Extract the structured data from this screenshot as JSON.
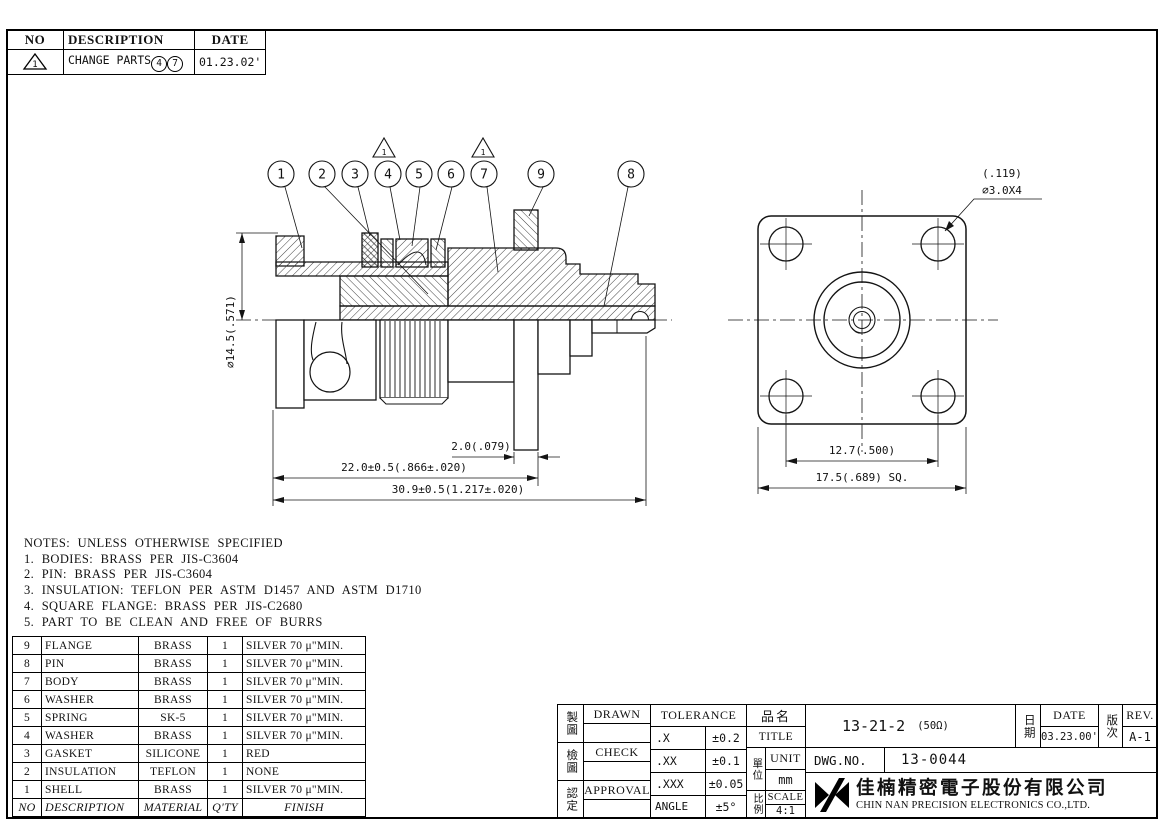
{
  "revision_table": {
    "headers": [
      "NO",
      "DESCRIPTION",
      "DATE"
    ],
    "row": {
      "mark": "1",
      "description": "CHANGE PARTS",
      "parts": [
        "4",
        "7"
      ],
      "date": "01.23.02'"
    }
  },
  "drawing": {
    "balloons": [
      "1",
      "2",
      "3",
      "4",
      "5",
      "6",
      "7",
      "9",
      "8"
    ],
    "rev_mark": "1",
    "side_view": {
      "diameter": "∅14.5(.571)",
      "flange_thickness": "2.0(.079)",
      "body_length": "22.0±0.5(.866±.020)",
      "overall_length": "30.9±0.5(1.217±.020)"
    },
    "front_view": {
      "hole_note_line1": "(.119)",
      "hole_note_line2": "∅3.0X4",
      "hole_spacing": "12.7(.500)",
      "square_size": "17.5(.689) SQ."
    }
  },
  "notes": {
    "title": "NOTES: UNLESS OTHERWISE SPECIFIED",
    "items": [
      "1. BODIES: BRASS PER JIS-C3604",
      "2. PIN: BRASS PER JIS-C3604",
      "3. INSULATION: TEFLON PER ASTM D1457 AND ASTM D1710",
      "4. SQUARE FLANGE: BRASS PER JIS-C2680",
      "5. PART TO BE CLEAN AND FREE OF BURRS"
    ]
  },
  "bom": {
    "headers": {
      "no": "NO",
      "description": "DESCRIPTION",
      "material": "MATERIAL",
      "qty": "Q'TY",
      "finish": "FINISH"
    },
    "rows": [
      {
        "no": "9",
        "description": "FLANGE",
        "material": "BRASS",
        "qty": "1",
        "finish": "SILVER 70 μ\"MIN."
      },
      {
        "no": "8",
        "description": "PIN",
        "material": "BRASS",
        "qty": "1",
        "finish": "SILVER 70 μ\"MIN."
      },
      {
        "no": "7",
        "description": "BODY",
        "material": "BRASS",
        "qty": "1",
        "finish": "SILVER 70 μ\"MIN."
      },
      {
        "no": "6",
        "description": "WASHER",
        "material": "BRASS",
        "qty": "1",
        "finish": "SILVER 70 μ\"MIN."
      },
      {
        "no": "5",
        "description": "SPRING",
        "material": "SK-5",
        "qty": "1",
        "finish": "SILVER 70 μ\"MIN."
      },
      {
        "no": "4",
        "description": "WASHER",
        "material": "BRASS",
        "qty": "1",
        "finish": "SILVER 70 μ\"MIN."
      },
      {
        "no": "3",
        "description": "GASKET",
        "material": "SILICONE",
        "qty": "1",
        "finish": "RED"
      },
      {
        "no": "2",
        "description": "INSULATION",
        "material": "TEFLON",
        "qty": "1",
        "finish": "NONE"
      },
      {
        "no": "1",
        "description": "SHELL",
        "material": "BRASS",
        "qty": "1",
        "finish": "SILVER 70 μ\"MIN."
      }
    ]
  },
  "title_block": {
    "drawn": {
      "zh": "製圖",
      "en": "DRAWN"
    },
    "check": {
      "zh": "檢圖",
      "en": "CHECK"
    },
    "approval": {
      "zh": "認定",
      "en": "APPROVAL"
    },
    "tolerance": {
      "header": "TOLERANCE",
      "rows": [
        {
          "label": ".X",
          "value": "±0.2"
        },
        {
          "label": ".XX",
          "value": "±0.1"
        },
        {
          "label": ".XXX",
          "value": "±0.05"
        },
        {
          "label": "ANGLE",
          "value": "±5°"
        }
      ]
    },
    "part_name": {
      "zh": "品名",
      "en": "TITLE",
      "value": "13-21-2",
      "suffix": "(50Ω)"
    },
    "unit": {
      "zh": "單位",
      "en": "UNIT",
      "value": "mm"
    },
    "scale": {
      "zh": "比例",
      "en": "SCALE",
      "value": "4:1"
    },
    "date": {
      "zh": "日期",
      "en": "DATE",
      "value": "03.23.00'"
    },
    "rev": {
      "zh": "版次",
      "en": "REV.",
      "value": "A-1"
    },
    "dwg_no": {
      "label": "DWG.NO.",
      "value": "13-0044"
    },
    "company": {
      "zh": "佳楠精密電子股份有限公司",
      "en": "CHIN NAN PRECISION ELECTRONICS CO.,LTD."
    }
  }
}
